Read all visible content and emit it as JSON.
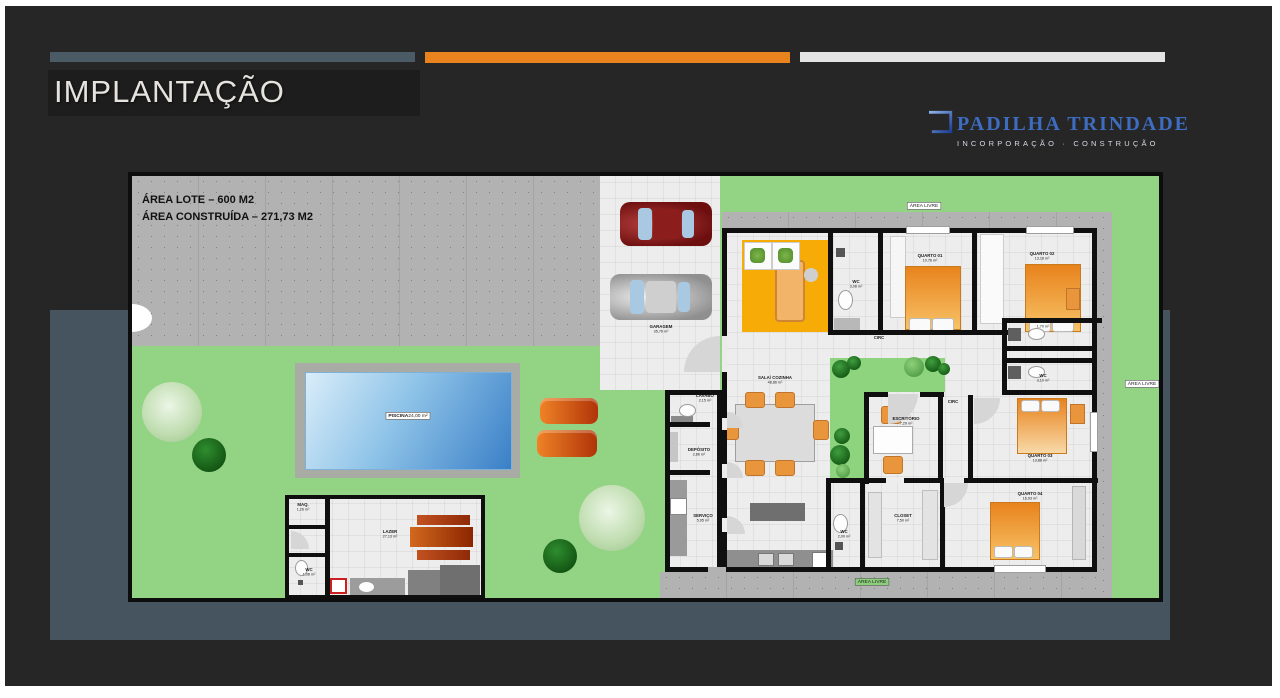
{
  "header": {
    "title": "IMPLANTAÇÃO"
  },
  "logo": {
    "name": "PADILHA TRINDADE",
    "tagline": "INCORPORAÇÃO · CONSTRUÇÃO"
  },
  "colors": {
    "bar_slate": "#4a5b66",
    "bar_orange": "#e8831d",
    "bar_white": "#e3e3e3",
    "slide_bg": "#262626",
    "panel_teal": "#45545e",
    "lawn_green": "#93d384",
    "pool_blue": "#3a7fc7",
    "logo_blue": "#3e6cc0"
  },
  "plan": {
    "notes": {
      "line1": "ÁREA LOTE – 600 M2",
      "line2": "ÁREA CONSTRUÍDA – 271,73 M2"
    },
    "badges": {
      "area_livre": "ÁREA LIVRE"
    },
    "labels": {
      "garagem": {
        "name": "GARAGEM",
        "area": "35,76 m²"
      },
      "quarto01": {
        "name": "QUARTO 01",
        "area": "10,76 m²"
      },
      "quarto02": {
        "name": "QUARTO 02",
        "area": "13,18 m²"
      },
      "quarto03": {
        "name": "QUARTO 03",
        "area": "13,86 m²"
      },
      "quarto04": {
        "name": "QUARTO 04",
        "area": "16,93 m²"
      },
      "wc_suite": {
        "name": "WC",
        "area": "3,08 m²"
      },
      "wc_1": {
        "name": "WC",
        "area": "1,70 m²"
      },
      "wc_2": {
        "name": "WC",
        "area": "3,10 m²"
      },
      "wc_closet": {
        "name": "WC",
        "area": "2,00 m²"
      },
      "wc_lazer": {
        "name": "WC",
        "area": "1,08 m²"
      },
      "closet": {
        "name": "CLOSET",
        "area": "7,50 m²"
      },
      "escritorio": {
        "name": "ESCRITÓRIO",
        "area": "7,29 m²"
      },
      "sala": {
        "name": "SALA/ COZINHA",
        "area": "48,86 m²"
      },
      "lavabo": {
        "name": "LAVABO",
        "area": "2,15 m²"
      },
      "deposito": {
        "name": "DEPÓSITO",
        "area": "2,86 m²"
      },
      "servico": {
        "name": "SERVIÇO",
        "area": "5,95 m²"
      },
      "maq": {
        "name": "MAQ.",
        "area": "1,26 m²"
      },
      "lazer": {
        "name": "LAZER",
        "area": "27,13 m²"
      },
      "piscina": {
        "name": "PISCINA",
        "area": "24,00 m²"
      },
      "circ": {
        "name": "CIRC"
      }
    }
  }
}
